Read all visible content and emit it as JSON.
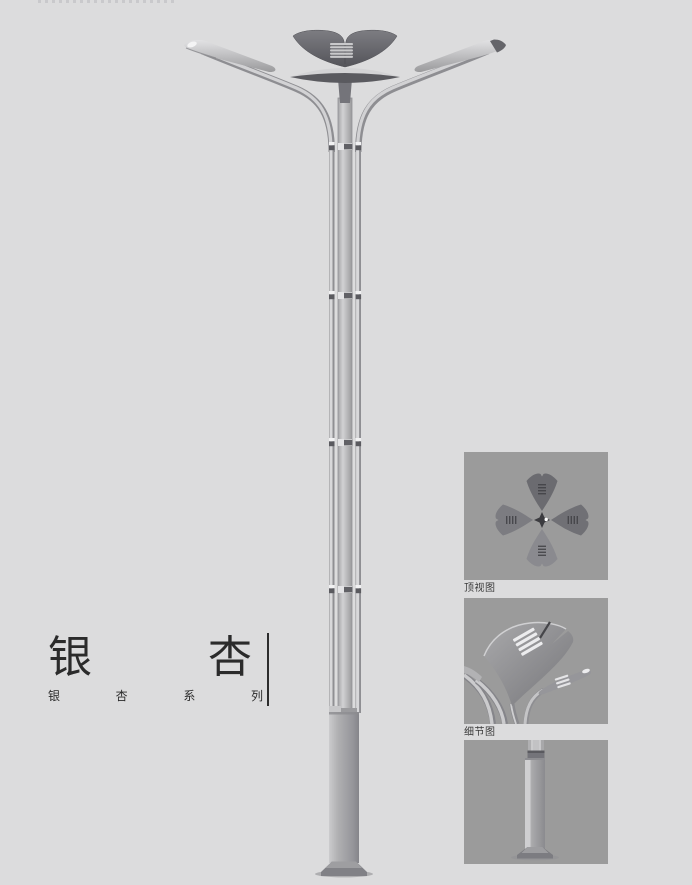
{
  "page": {
    "background_color": "#dcdcdd",
    "photo_background_color": "#9b9b9b"
  },
  "title": {
    "main": "银杏",
    "sub": "银杏系列"
  },
  "detail_views": [
    {
      "label": "顶视图"
    },
    {
      "label": "细节图"
    },
    {
      "label": ""
    }
  ],
  "colors": {
    "title_text": "#2b2b2b",
    "divider_line": "#2c2c2c",
    "label_text": "#3a3a3a",
    "lamp_metal_light": "#d4d4d6",
    "lamp_metal_mid": "#aeaeb0",
    "lamp_metal_dark": "#55555a"
  }
}
